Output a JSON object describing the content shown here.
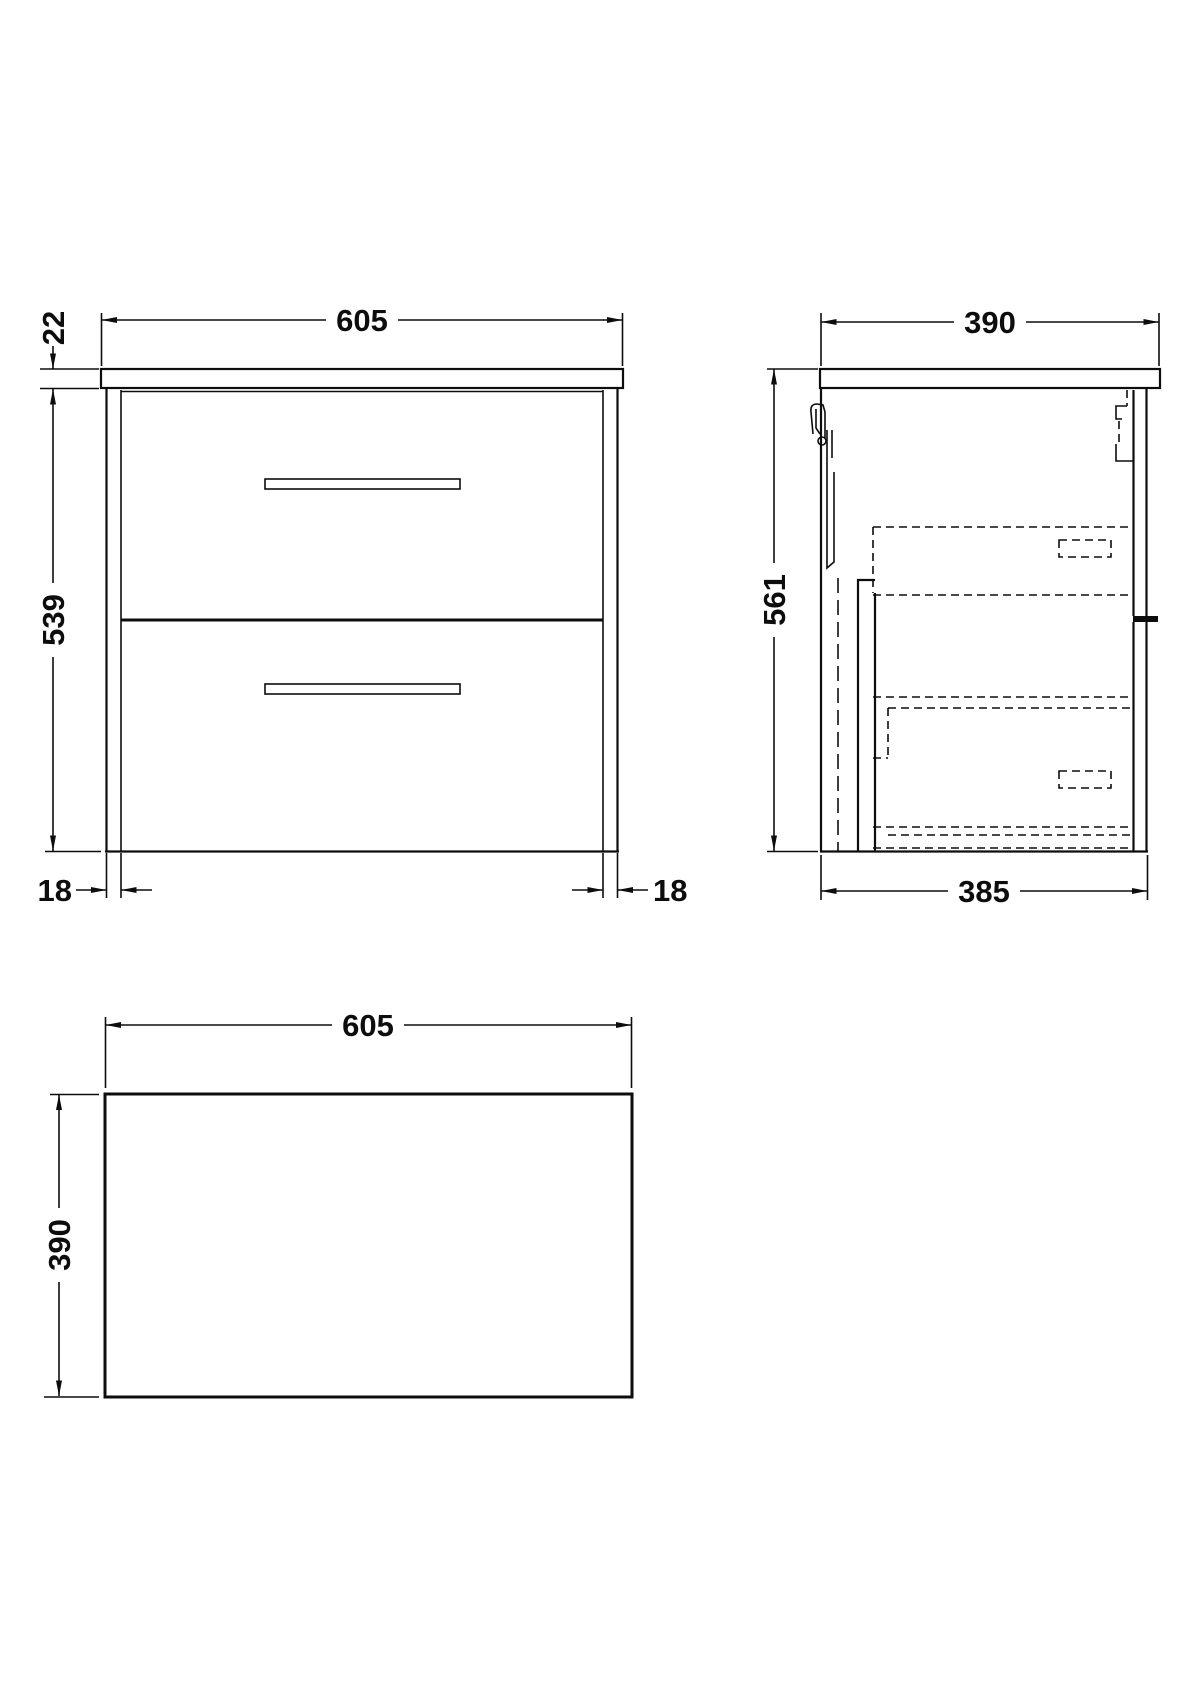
{
  "drawing": {
    "front_view": {
      "dim_width_top": "605",
      "dim_counter_thickness": "22",
      "dim_body_height": "539",
      "dim_side_panel_left": "18",
      "dim_side_panel_right": "18"
    },
    "side_view": {
      "dim_depth_top": "390",
      "dim_total_height": "561",
      "dim_depth_bottom": "385"
    },
    "plan_view": {
      "dim_width": "605",
      "dim_depth": "390"
    },
    "colors": {
      "line": "#0d0d0d",
      "background": "#ffffff"
    }
  }
}
